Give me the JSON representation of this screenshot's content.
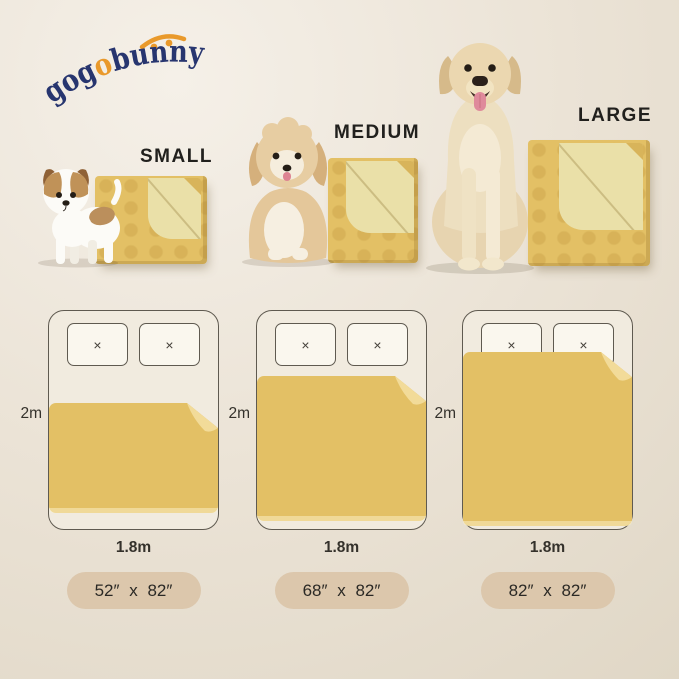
{
  "brand": {
    "name": "gogobunny",
    "prefix": "gog",
    "accent": "o",
    "suffix": "bunny"
  },
  "sizes": [
    {
      "id": "small",
      "label": "SMALL",
      "pill": "52″ x 82″",
      "dog_illustration": "jack-russell-terrier-puppy"
    },
    {
      "id": "medium",
      "label": "MEDIUM",
      "pill": "68″ x 82″",
      "dog_illustration": "fluffy-cream-puppy"
    },
    {
      "id": "large",
      "label": "LARGE",
      "pill": "82″ x 82″",
      "dog_illustration": "golden-retriever"
    }
  ],
  "bed": {
    "height_label": "2m",
    "width_label": "1.8m",
    "pillow_mark": "×",
    "pillows_per_bed": 2
  },
  "colors": {
    "logo-navy": "#27356f",
    "logo-orange": "#e9992b",
    "blanket": "#e3c065",
    "blanket-fold": "#eae0a8",
    "blanket-flap": "#f2db99",
    "bed-fill": "#f1ebdf",
    "bed-border": "#5f5a50",
    "pillow-fill": "#faf7ee",
    "pill-bg": "#dcc7ac",
    "pill-text": "#2b2925",
    "label-text": "#21201d",
    "dim-text": "#34312b",
    "bg": "#ebe3d6"
  }
}
